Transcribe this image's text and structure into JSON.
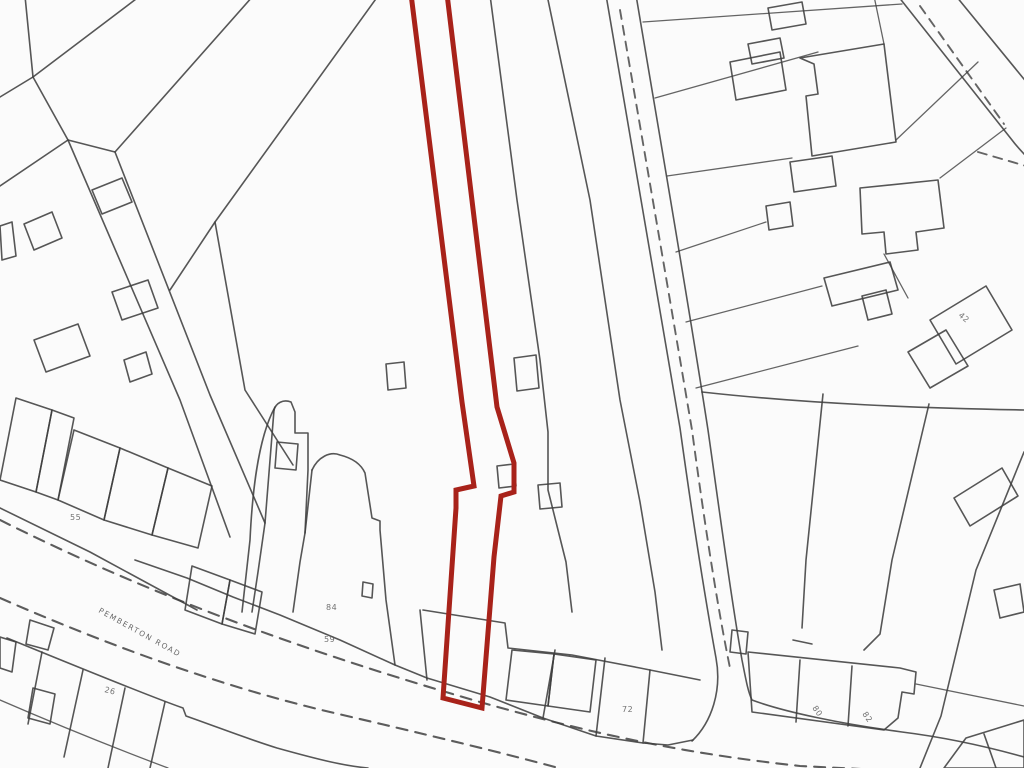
{
  "map": {
    "type": "cadastral-site-plan",
    "road_label": {
      "text": "PEMBERTON ROAD"
    },
    "plot_labels": [
      {
        "id": "label-55",
        "text": "55"
      },
      {
        "id": "label-84",
        "text": "84"
      },
      {
        "id": "label-59",
        "text": "59"
      },
      {
        "id": "label-26",
        "text": "26"
      },
      {
        "id": "label-72",
        "text": "72"
      },
      {
        "id": "label-80",
        "text": "80"
      },
      {
        "id": "label-82",
        "text": "82"
      },
      {
        "id": "label-42",
        "text": "42"
      }
    ],
    "highlighted_plot": {
      "description": "narrow strip plot outlined in red running from top edge down to Pemberton Road frontage"
    },
    "colors": {
      "background": "#fbfbfb",
      "line": "#3f3f3f",
      "highlight_red": "#a8221a",
      "label": "#4f4f4f"
    }
  }
}
